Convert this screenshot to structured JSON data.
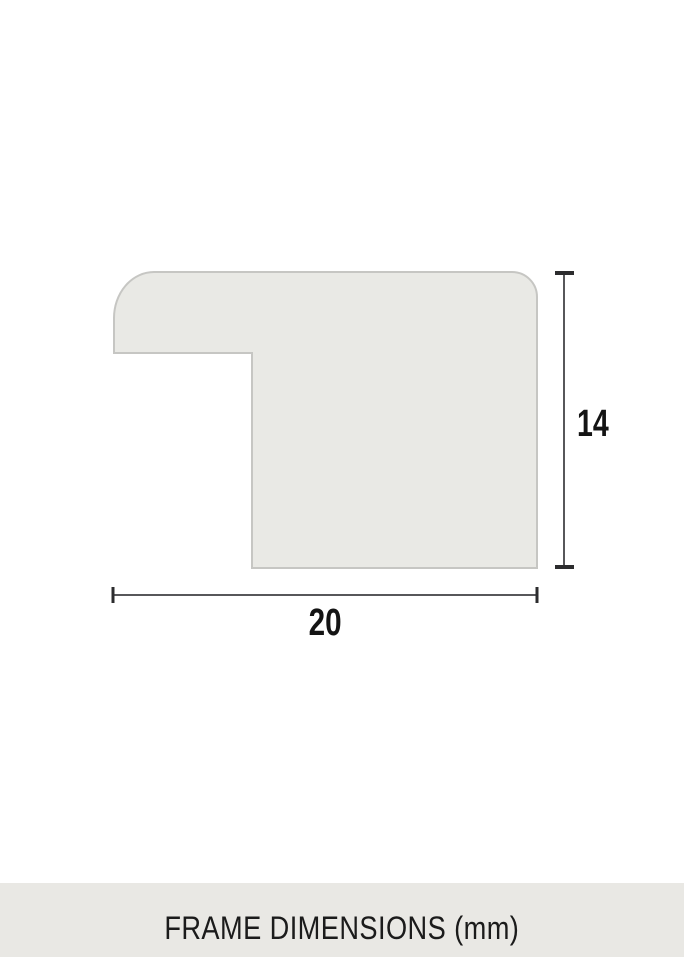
{
  "diagram": {
    "width_value": "20",
    "height_value": "14",
    "unit": "mm",
    "shape_fill": "#e9e9e5",
    "shape_stroke": "#c6c6c3",
    "dim_line_color": "#57575a",
    "dim_tick_color": "#2c2c2e",
    "dim_label_color": "#141414"
  },
  "footer": {
    "label": "FRAME DIMENSIONS (mm)",
    "bg_color": "#e9e8e4",
    "text_color": "#1b1b1b"
  }
}
